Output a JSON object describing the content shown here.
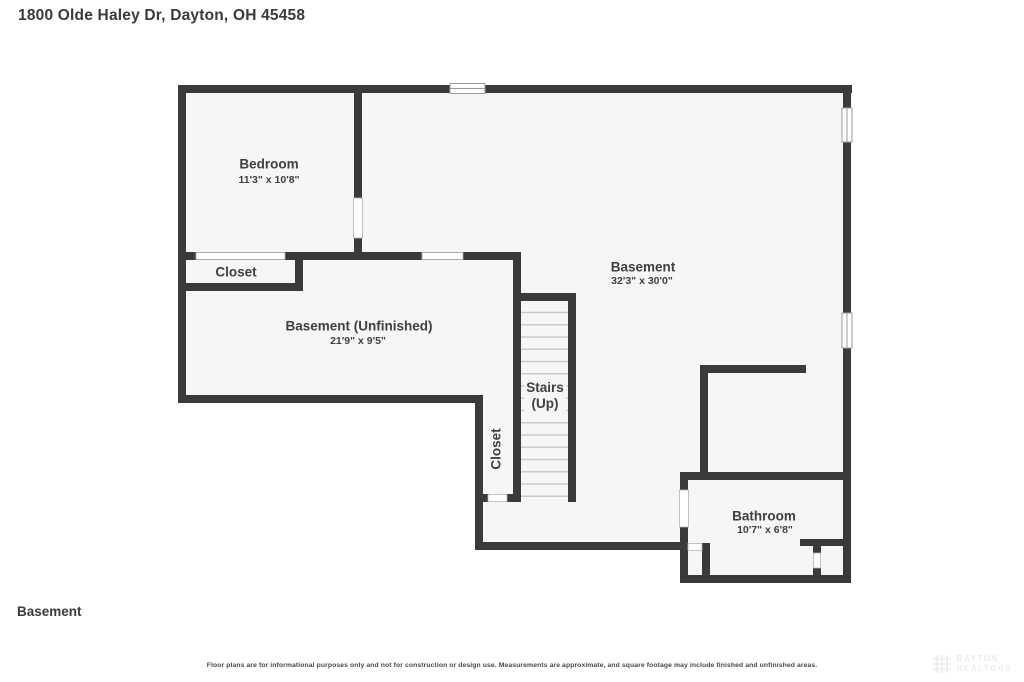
{
  "header": {
    "address": "1800 Olde Haley Dr, Dayton, OH 45458"
  },
  "plan": {
    "rooms": {
      "bedroom": {
        "name": "Bedroom",
        "dims": "11'3\" x 10'8\""
      },
      "bedroom_closet": {
        "name": "Closet"
      },
      "basement_unfinished": {
        "name": "Basement (Unfinished)",
        "dims": "21'9\" x 9'5\""
      },
      "basement": {
        "name": "Basement",
        "dims": "32'3\" x 30'0\""
      },
      "stairs": {
        "line1": "Stairs",
        "line2": "(Up)"
      },
      "stair_closet": {
        "name": "Closet"
      },
      "bathroom": {
        "name": "Bathroom",
        "dims": "10'7\" x 6'8\""
      }
    },
    "colors": {
      "wall": "#3a3a3a",
      "floor": "#f6f6f6",
      "opening_line": "#ababab",
      "stair_tread": "#c9c9c9",
      "text": "#3f3f3f"
    }
  },
  "footer": {
    "floor_label": "Basement",
    "disclaimer": "Floor plans are for informational purposes only and not for construction or design use. Measurements are approximate, and square footage may include finished and unfinished areas.",
    "watermark_line1": "DAYTON",
    "watermark_line2": "REALTORS"
  }
}
